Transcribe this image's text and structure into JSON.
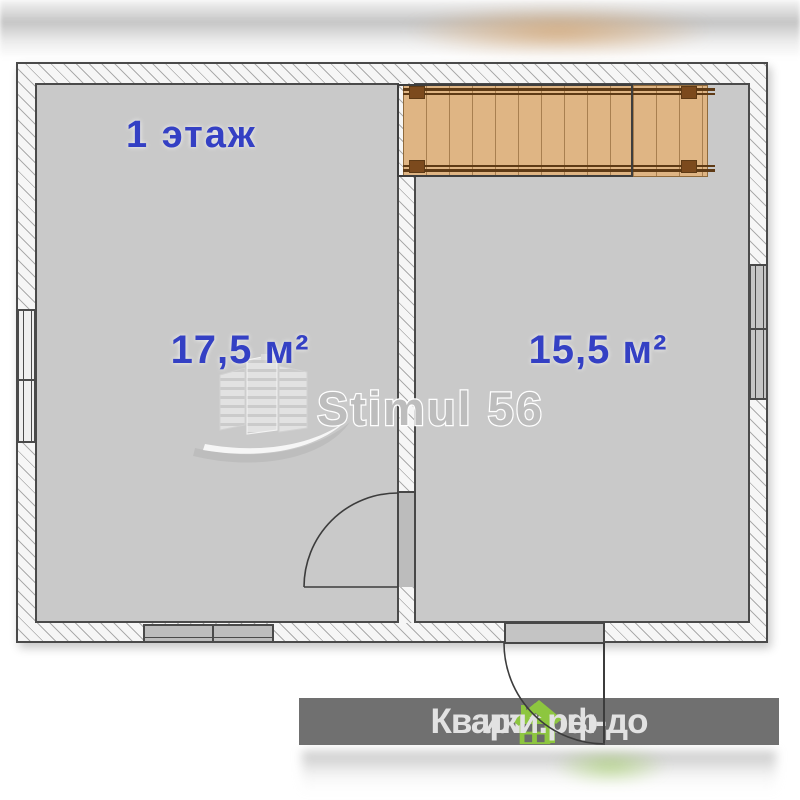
{
  "plan": {
    "floor_label": "1 этаж",
    "type_label": "floor-plan"
  },
  "rooms": [
    {
      "id": "room-1",
      "area_label": "17,5 м²"
    },
    {
      "id": "room-2",
      "area_label": "15,5 м²"
    }
  ],
  "watermark_logo": {
    "text": "Stimul 56"
  },
  "watermark_banner": {
    "text_full": "Квартиры-домики.рф",
    "text_before_houses": "Квартиры-до",
    "text_after_houses": "ики.рф",
    "house_icon_count": 2
  },
  "graphic_elements": [
    "wooden-staircase-top-right",
    "stairwell-opening-outline",
    "interior-door-swing-left-room",
    "exterior-door-swing-bottom-right",
    "window-left-wall",
    "window-right-wall",
    "window-bottom-wall-left-room"
  ],
  "colors": {
    "label_blue": "#3440c4",
    "room_fill": "#c9c9c9",
    "wall_outline": "#4a4a4a",
    "stair_wood": "#dfb584",
    "stair_rail": "#5e3a15",
    "banner_bg": "#686868",
    "banner_text": "#e2e2e2",
    "house_green": "#8dc63f",
    "logo_gray": "#bdbdbd"
  }
}
